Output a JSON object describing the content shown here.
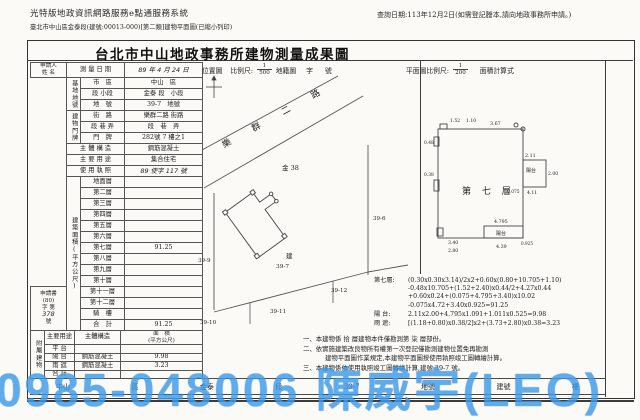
{
  "header": {
    "system": "光特版地政資訊網路服務e點通服務系統",
    "subtitle": "臺北市中山區金泰段(建號:00013-000)[第二類]建物平面圖(已縮小列印)",
    "query_date": "查詢日期:113年12月2日(如需登記謄本,請向地政事務所申請。)"
  },
  "title": "台北市中山地政事務所建物測量成果圖",
  "form": {
    "applicant_l1": "申請人",
    "applicant_l2": "姓 名",
    "survey_label": "測 量 日 期",
    "survey_value": "89 年 4 月 24 日",
    "site_group": "基地地號",
    "site_rows": [
      {
        "label": "市　區",
        "value": "中山　區"
      },
      {
        "label": "段 小段",
        "value": "金泰 段　小段"
      },
      {
        "label": "地　號",
        "value": "39-7　地號"
      }
    ],
    "addr_group": "建物門牌",
    "addr_rows": [
      {
        "label": "街　路",
        "value": "樂群二路 街路"
      },
      {
        "label": "段 巷 弄",
        "value": "段　巷　弄"
      },
      {
        "label": "門　牌",
        "value": "282號 7 樓之1"
      }
    ],
    "struct_label": "主 體 構 造",
    "struct_value": "鋼筋混凝土",
    "use_label": "主 要 用 途",
    "use_value": "集合住宅",
    "license_label": "使 用 執 照",
    "license_value": "89 使字 117 號",
    "area_group": "建築面積(平方公尺)",
    "floors": [
      {
        "label": "地面層",
        "value": ""
      },
      {
        "label": "第二層",
        "value": ""
      },
      {
        "label": "第三層",
        "value": ""
      },
      {
        "label": "第四層",
        "value": ""
      },
      {
        "label": "第五層",
        "value": ""
      },
      {
        "label": "第六層",
        "value": ""
      },
      {
        "label": "第七層",
        "value": "91.25"
      },
      {
        "label": "第八層",
        "value": ""
      },
      {
        "label": "第九層",
        "value": ""
      },
      {
        "label": "第十層",
        "value": ""
      },
      {
        "label": "第十一層",
        "value": ""
      },
      {
        "label": "第十二層",
        "value": ""
      }
    ],
    "app_box": [
      "申請書",
      "(80)",
      "字 第",
      "378",
      "號"
    ],
    "arcade_label": "騎　樓",
    "arcade_value": "",
    "total_label": "合　計",
    "total_value": "91.25",
    "annex_group": "附屬建物",
    "annex_headers": {
      "use": "主要用途",
      "structure": "主體構造",
      "area_l1": "面　積",
      "area_l2": "(平方公尺)"
    },
    "annex_rows": [
      {
        "use": "平 台",
        "structure": "",
        "area": ""
      },
      {
        "use": "陽 台",
        "structure": "鋼筋混凝土",
        "area": "9.98"
      },
      {
        "use": "雨 遮",
        "structure": "鋼筋混凝土",
        "area": "3.23"
      },
      {
        "use": "合 計",
        "structure": "",
        "area": ""
      }
    ],
    "strip": [
      "中山",
      "區",
      "金泰",
      "段",
      "39-7",
      "地號",
      "建號",
      "樓"
    ]
  },
  "map": {
    "label": "位置圖",
    "scale_label": "比例尺:",
    "scale_num": "1",
    "scale_den": "500",
    "suffix1": "地籍圖",
    "suffix2": "字",
    "suffix3": "號",
    "road": "樂 群 二 路",
    "lot38": "金 38",
    "lot399": "39-9",
    "lot396": "39-6",
    "lot3910": "39-10",
    "lot3911": "39-11",
    "lot3912": "39-12",
    "bldg_mark": "建",
    "bldg_lot": "39-7"
  },
  "plan": {
    "scale_label": "平面圖比例尺:",
    "scale_num": "1",
    "scale_den": "200",
    "suffix": "面積計算式",
    "room": "第 七 層",
    "dims": {
      "t1": "1.52",
      "t2": "1.10",
      "t3": "3.67",
      "r1": "2.11",
      "r2": "2.00",
      "r3": "0.075",
      "r4": "4.11",
      "b1": "4.795",
      "b2": "4.39",
      "b3": "0.925",
      "l1": "0.48",
      "l2": "0.38",
      "l3": "3.40",
      "l4": "2.80",
      "balcony1": "陽台",
      "balcony2": "陽台"
    }
  },
  "calc": {
    "floor_label": "第七層:",
    "lines": [
      "(0.30x0.30x3.14)/2x2+0.60x(0.80+10.705+1.10)",
      "-0.48x10.705+(1.52+2.40)x0.44/2+4.27x0.44",
      "+0.60x0.24+(0.075+4.795+3.40)x10.02",
      "-0.075x4.72+3.40x0.925=91.25"
    ],
    "balcony_label": "陽 台:",
    "balcony": "2.11x2.00+4.795x1.091+1.011x0.525=9.98",
    "canopy_label": "雨 遮:",
    "canopy": "[(1.18+0.80)x0.38/2]x2+(3.73+2.80)x0.38=3.23"
  },
  "notes": {
    "n1": "一、本建物係 拾 層建物本件僅勘測第 柒 層部份。",
    "n2": "二、依實施建築改良物所有權第一次登記僅勘測建物位置免再勘測",
    "n2b": "建物平面圖作業規定,本建物平面圖按使用執照竣工圖轉繪計算。",
    "n3": "三、本建物係依使用執照竣工圖轉繪計算,建號 39-7 號。"
  },
  "watermark": "0985-048006 陳威宇(LEO)"
}
